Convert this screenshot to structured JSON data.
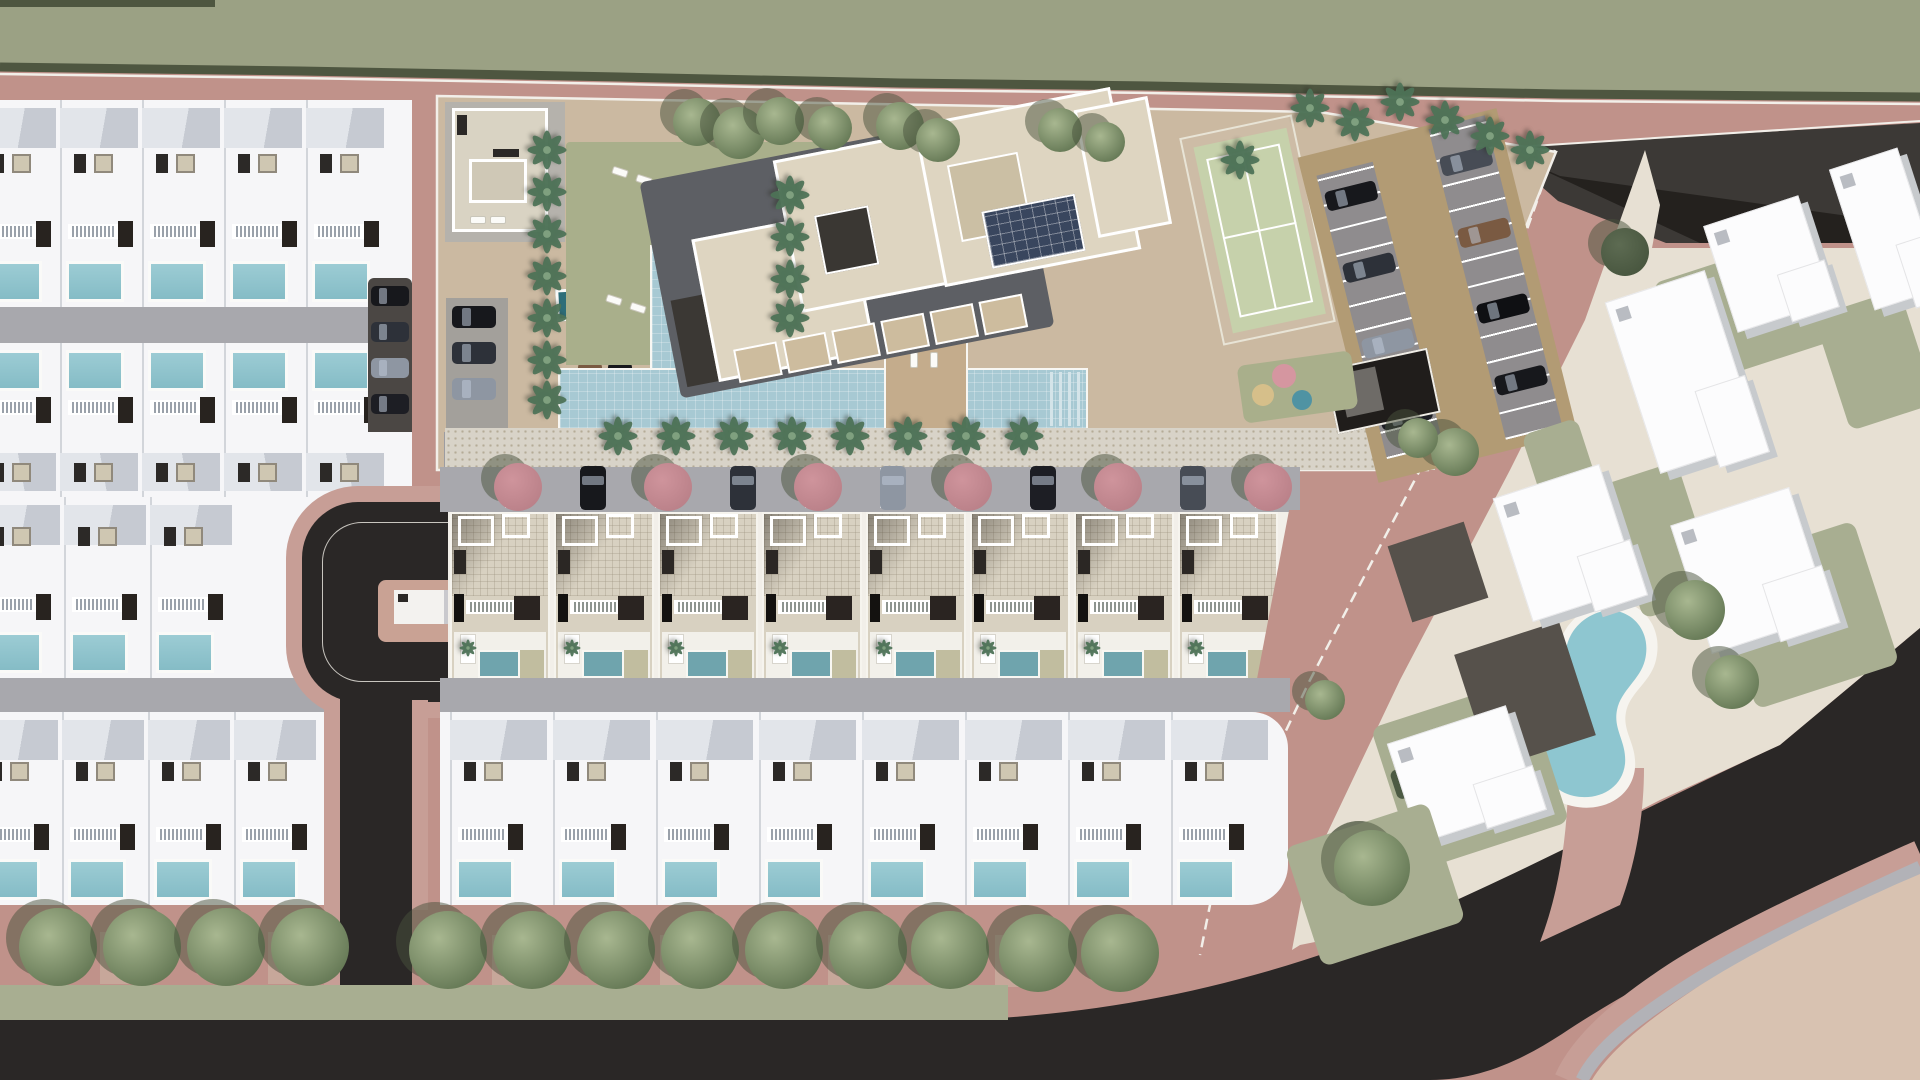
{
  "scene": {
    "title": "Aerial master-plan rendering of a residential resort development with villas, townhouses, apartment block and amenity gardens",
    "view": "top-down architectural 3D render",
    "visible_text": "none"
  },
  "palette": {
    "ground_pink": "#c0928a",
    "sidewalk_pink": "#c79e96",
    "greenbelt": "#9ba184",
    "hedge": "#4e5640",
    "boundary_line": "#f2efe9",
    "villa_white": "#f6f6f8",
    "roof_gray_light": "#e2e5ea",
    "roof_gray_dark": "#c6cad2",
    "street_gray": "#a8a8ad",
    "asphalt": "#2a2726",
    "asphalt_deep": "#24211e",
    "road_dark_gray": "#3c3936",
    "driveway_dark": "#4b4744",
    "pool_blue": "#8ec3cc",
    "townhouse_pool_teal": "#6fa4ad",
    "deck_beige": "#c1bd9f",
    "compound_tan": "#cbb9a1",
    "promenade": "#d8d3c8",
    "lawn_sage": "#a9af8b",
    "big_pool_blue": "#a7c9d3",
    "plunge_pool_teal": "#2e6e79",
    "palm_green": "#4e7358",
    "tree_green": "#7e9070",
    "tree_shadow": "#47523c",
    "flowering_tree_pink": "#cf949c",
    "tennis_green": "#c6d1ab",
    "tennis_apron": "#cdbca6",
    "parking_tan": "#b29b74",
    "parking_stall_gray": "#8f8c8e",
    "apartment_roof_beige": "#ded5c1",
    "apartment_shadow": "#5d5f64",
    "solar_panel_blue": "#39465e",
    "playground_pink": "#d596a0",
    "playground_yellow": "#d6bf8a",
    "playground_teal": "#4f93a3",
    "neighborhood_cream": "#e7e0d3",
    "neighborhood_sage": "#a8ae91",
    "neighborhood_lot_dark": "#56514b",
    "corner_tan": "#d8c2b1",
    "sidewalk_gray": "#b2b2b7",
    "kidney_pool": "#8ec6d0",
    "townhouse_roof": "#d8d1c1",
    "car_colors": [
      "#17181c",
      "#2d3139",
      "#8e96a2",
      "#1d1e24",
      "#474c55",
      "#7a5a42",
      "#0f1013"
    ]
  },
  "regions": {
    "greenbelt_top": {
      "label": "undeveloped greenbelt strip with boundary hedge"
    },
    "perimeter_road": {
      "label": "pink perimeter road wrapping the development"
    },
    "left_villa_block": {
      "label": "block of detached white villas with private pools",
      "rows": [
        {
          "villas": 5,
          "pool_side": "south"
        },
        {
          "villas": 5,
          "pool_side": "north"
        },
        {
          "villas": 3,
          "pool_side": "south"
        },
        {
          "villas": 4,
          "pool_side": "south"
        }
      ],
      "internal_streets": 2
    },
    "cul_de_sac": {
      "label": "asphalt loop road with landscaped centre island and access stem",
      "island_building": 1
    },
    "driveway_parking": {
      "cars": 4
    },
    "amenity_compound": {
      "label": "resort amenity compound",
      "features": [
        "pool house",
        "sun lawn",
        "L-shaped swimming pool",
        "sun deck island",
        "apartment building with roof terraces and solar panels",
        "tennis court",
        "angled parking rows",
        "garage ramp",
        "playground"
      ],
      "palm_trees": 26,
      "round_trees": 8,
      "sun_loungers": 14,
      "parking_cars": 8,
      "visitor_cars": 5,
      "playground_balls": 3
    },
    "townhouse_row": {
      "units": 8,
      "unit_features": [
        "tiled roof terrace",
        "balcony",
        "plunge pool",
        "palm planter"
      ]
    },
    "townhouse_street": {
      "flowering_trees": 6,
      "parked_cars": 5
    },
    "bottom_villa_row": {
      "villas": 8
    },
    "boulevard_south": {
      "street_trees_west": 4,
      "street_trees_center": 7,
      "street_trees_east": 2,
      "lone_tree": 1,
      "lawn_verge": true
    },
    "right_neighborhood": {
      "label": "existing neighbourhood parcels",
      "buildings": 6,
      "kidney_pool": 1,
      "trees": 7,
      "dark_lots": 2,
      "sage_lawns": 6
    }
  }
}
